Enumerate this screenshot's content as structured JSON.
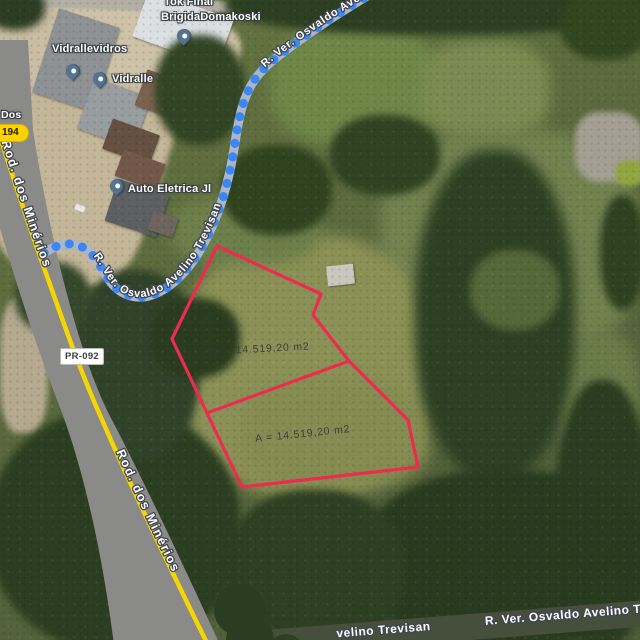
{
  "map_type": "satellite",
  "parcel": {
    "area_label_upper": "A = 14.519,20 m2",
    "area_label_lower": "A = 14.519,20 m2"
  },
  "roads": {
    "highway_name": "Rod. dos Minérios",
    "highway_name_2": "Rod. dos Minérios",
    "street_name": "R. Ver. Osvaldo Avelino Trevisan",
    "street_name_upper": "R. Ver. Osvaldo Avelino Trevisan",
    "bottom_left_label": "velino Trevisan",
    "bottom_right_label": "R. Ver. Osvaldo Avelino Tr",
    "shield_pr092": "PR-092",
    "shield_dos": "Dos",
    "shield_194": "194"
  },
  "places": [
    {
      "name": "Vidrallevidros"
    },
    {
      "name": "Vidralle"
    },
    {
      "name_line1": "Tok Final",
      "name_line2": "BrigidaDomakoski"
    },
    {
      "name": "Auto Eletrica Jl"
    }
  ],
  "colors": {
    "parcel_outline": "#ef2a4f",
    "route_dot": "#3d87f5",
    "route_band": "#a9b6cb",
    "highway_line": "#f6d602",
    "road_gray": "#8a8a88",
    "bottom_road": "#464e3c",
    "pin": "#54738f",
    "area_text": "#34383b",
    "label_text": "#ffffff",
    "shield_194_bg": "#fcd200"
  }
}
